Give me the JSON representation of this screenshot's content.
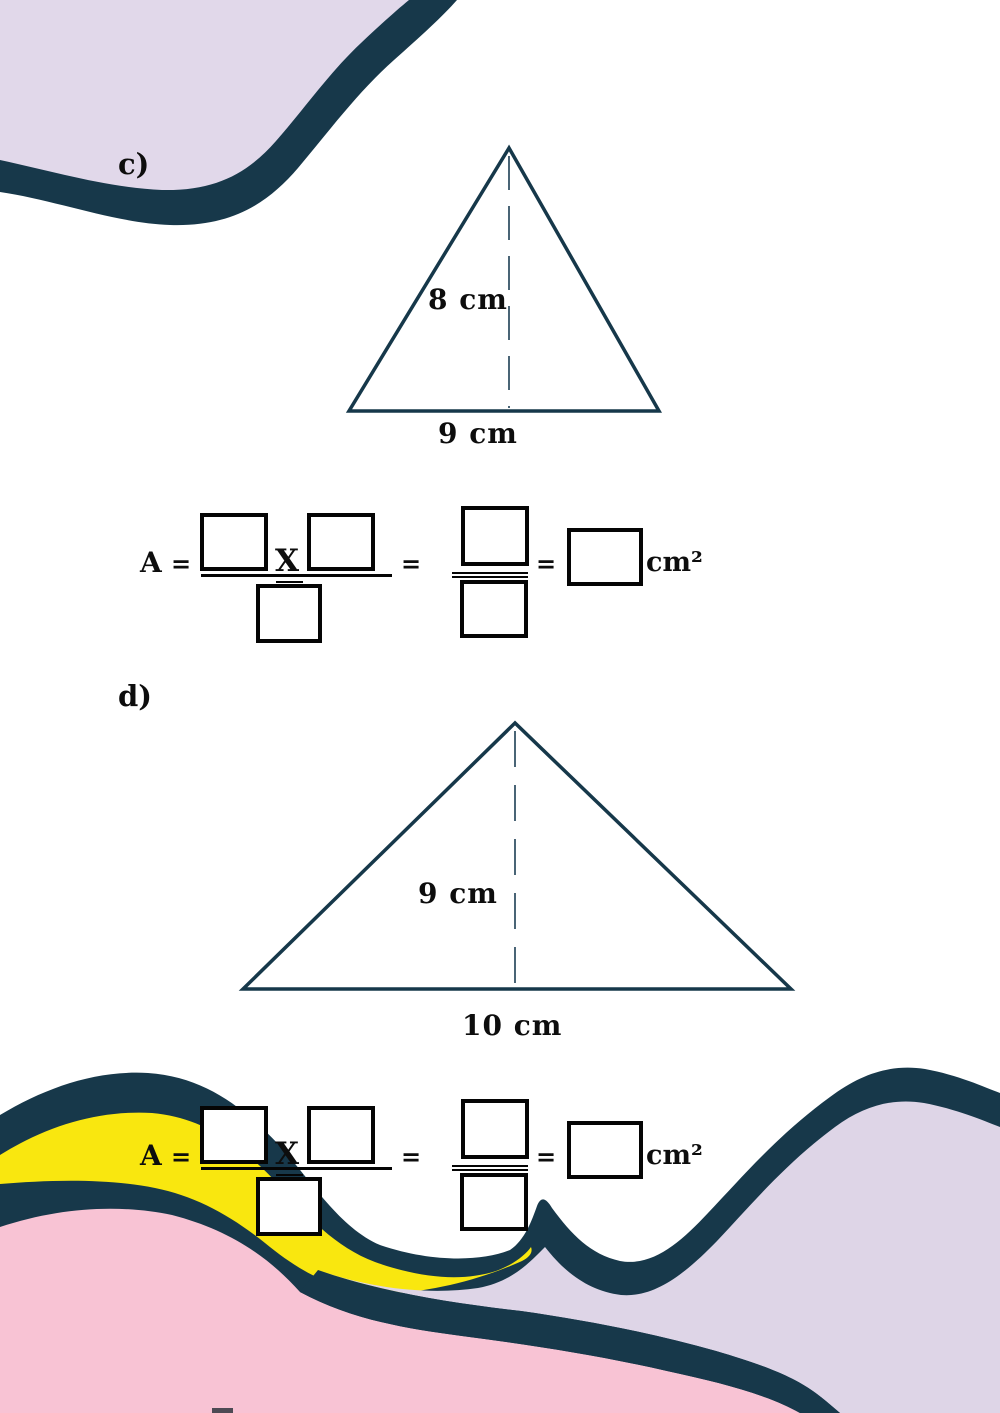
{
  "title": "Area of a triangle worksheet",
  "colors": {
    "teal": "#17384a",
    "lavender_top": "#e1d8ea",
    "lavender_bottom": "#ded5e7",
    "yellow": "#f9e70f",
    "pink": "#f8c3d4",
    "white": "#ffffff",
    "triangle_stroke": "#16384a",
    "dash_stroke": "#2a4a5e",
    "ink": "#0d0d0d",
    "bottom_sliver": "#4e4a54"
  },
  "problems": [
    {
      "label": "c)",
      "triangle": {
        "height_label": "8 cm",
        "base_label": "9 cm"
      }
    },
    {
      "label": "d)",
      "triangle": {
        "height_label": "9 cm",
        "base_label": "10 cm"
      }
    }
  ],
  "formula": {
    "area_symbol": "A",
    "equals": "=",
    "multiply_symbol": "X",
    "unit": "cm²"
  }
}
